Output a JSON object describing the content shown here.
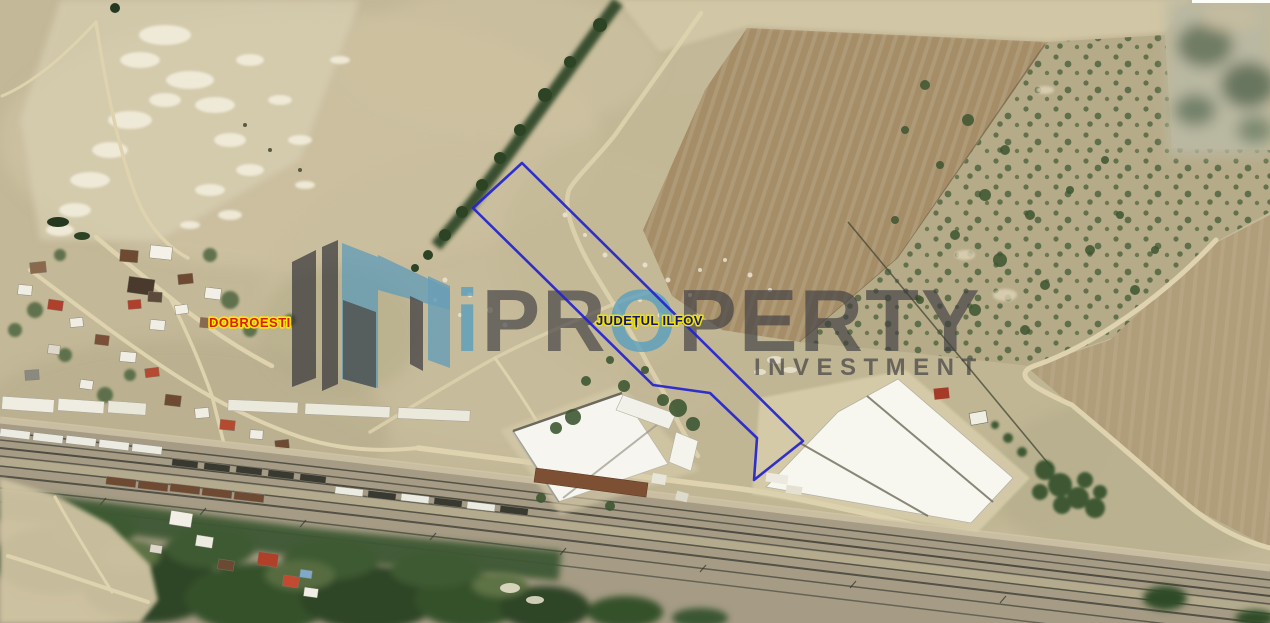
{
  "map": {
    "type": "satellite-aerial-view",
    "labels": [
      {
        "id": "dobroesti",
        "text": "DOBROESTI",
        "color": "#d61f0f",
        "outline": "#ffe608"
      },
      {
        "id": "judetul-ilfov",
        "text": "JUDEȚUL ILFOV",
        "color": "#15157a",
        "outline": "#f0e206"
      }
    ],
    "parcel": {
      "points": "522,163 473,208 653,385 710,393 757,438 754,480 803,441",
      "stroke": "#2323cd"
    }
  },
  "watermark": {
    "brand_i": "i",
    "brand_pr": "PR",
    "brand_o": "O",
    "brand_perty": "PERTY",
    "subtitle": "INVESTMENT",
    "accent_color": "#4f9cc4",
    "dark_color": "#3f3e42"
  }
}
